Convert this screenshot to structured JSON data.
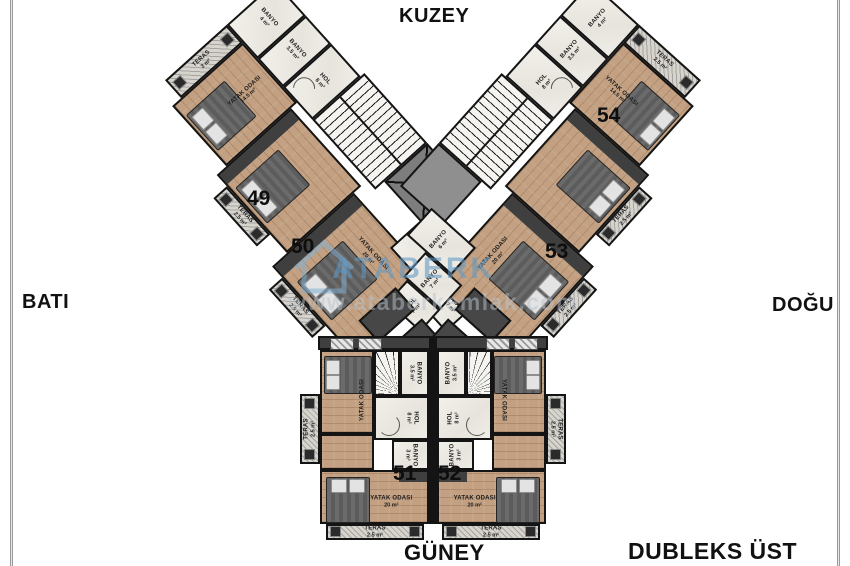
{
  "compass": {
    "north": "KUZEY",
    "south": "GÜNEY",
    "west": "BATI",
    "east": "DOĞU"
  },
  "caption": "DUBLEKS ÜST KAT",
  "watermark": {
    "brand": "ATABERK",
    "url": "www.ataberkemlak.com",
    "color": "#5f98c6"
  },
  "units": {
    "u49": "49",
    "u50": "50",
    "u51": "51",
    "u52": "52",
    "u53": "53",
    "u54": "54"
  },
  "wing": {
    "teras_top": {
      "name": "TERAS",
      "area": "3 m²"
    },
    "bedroom_small": {
      "name": "YATAK ODASI",
      "area": "14.5 m²"
    },
    "banyo4m": {
      "name": "BANYO",
      "area": "4 m²"
    },
    "banyo35": {
      "name": "BANYO",
      "area": "3.5 m²"
    },
    "hol8": {
      "name": "HOL",
      "area": "8 m²"
    },
    "teras25": {
      "name": "TERAS",
      "area": "2.5 m²"
    },
    "bedroom_big": {
      "name": "YATAK ODASI",
      "area": "20 m²"
    },
    "banyo6": {
      "name": "BANYO",
      "area": "6 m²"
    },
    "banyo7": {
      "name": "BANYO",
      "area": "7 m²"
    },
    "hol7": {
      "name": "HOL",
      "area": "7 m²"
    }
  },
  "bottom": {
    "banyo35": {
      "name": "BANYO",
      "area": "3.5 m²"
    },
    "hol8": {
      "name": "HOL",
      "area": "8 m²"
    },
    "banyo3": {
      "name": "BANYO",
      "area": "3 m²"
    },
    "bedroom": {
      "name": "YATAK ODASI",
      "area": ""
    },
    "bedroom_big": {
      "name": "YATAK ODASI",
      "area": "20 m²"
    },
    "teras": {
      "name": "TERAS",
      "area": "2.5 m²"
    }
  }
}
